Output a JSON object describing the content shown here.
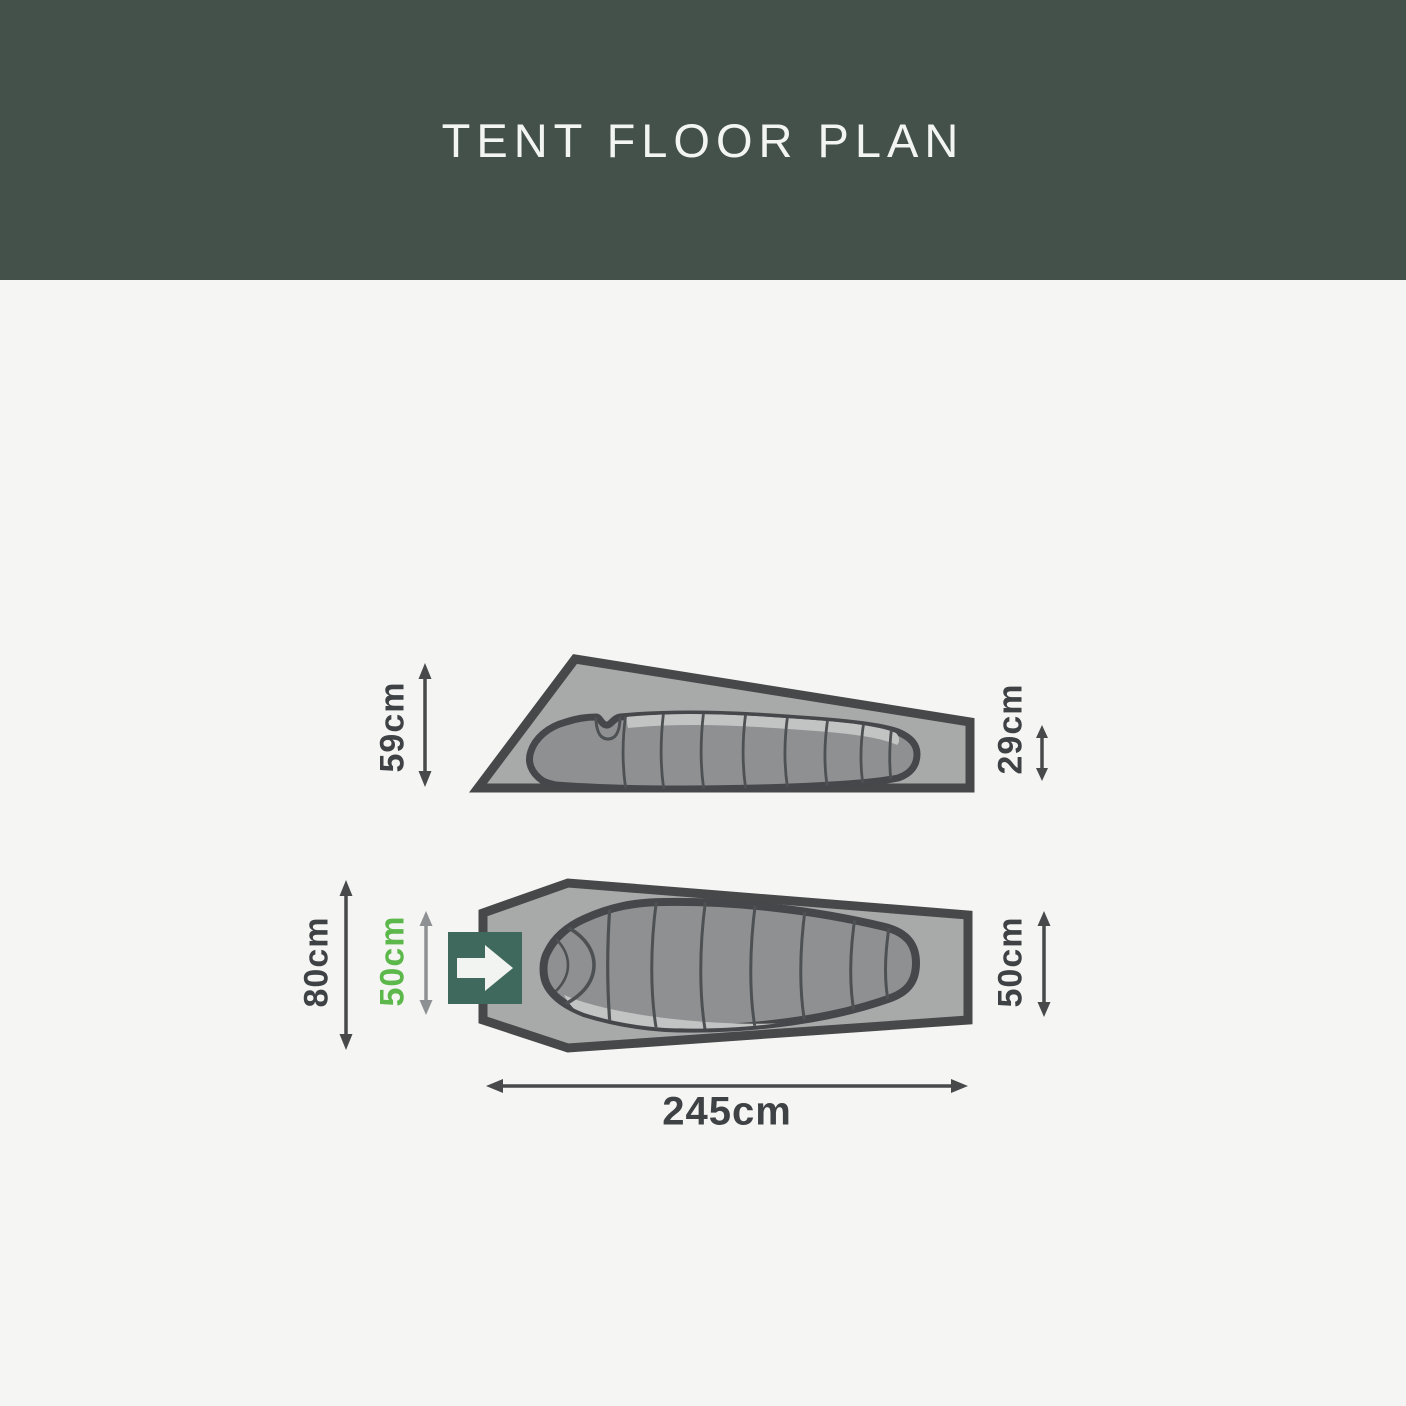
{
  "title": "TENT FLOOR PLAN",
  "side_view": {
    "left_dim": "59cm",
    "right_dim": "29cm"
  },
  "top_view": {
    "outer_width": "80cm",
    "door_width": "50cm",
    "foot_width": "50cm",
    "length": "245cm"
  },
  "icons": {
    "door": "right-arrow-icon"
  },
  "colors": {
    "header_bg": "#43514A",
    "page_bg": "#F5F5F3",
    "title_text": "#F3F5F2",
    "dim_text": "#3F4245",
    "green_text": "#5CB84A",
    "arrow_dark": "#47494B",
    "arrow_gray": "#8E9193",
    "door_green": "#3E695C",
    "door_arrow": "#F2F4F1",
    "tent_fill": "#A8A9A9",
    "tent_stroke": "#474849",
    "bag_fill": "#8E9092",
    "bag_light": "#C2C4C4",
    "bag_stroke": "#45474A",
    "rib_stroke": "#4E5153"
  }
}
